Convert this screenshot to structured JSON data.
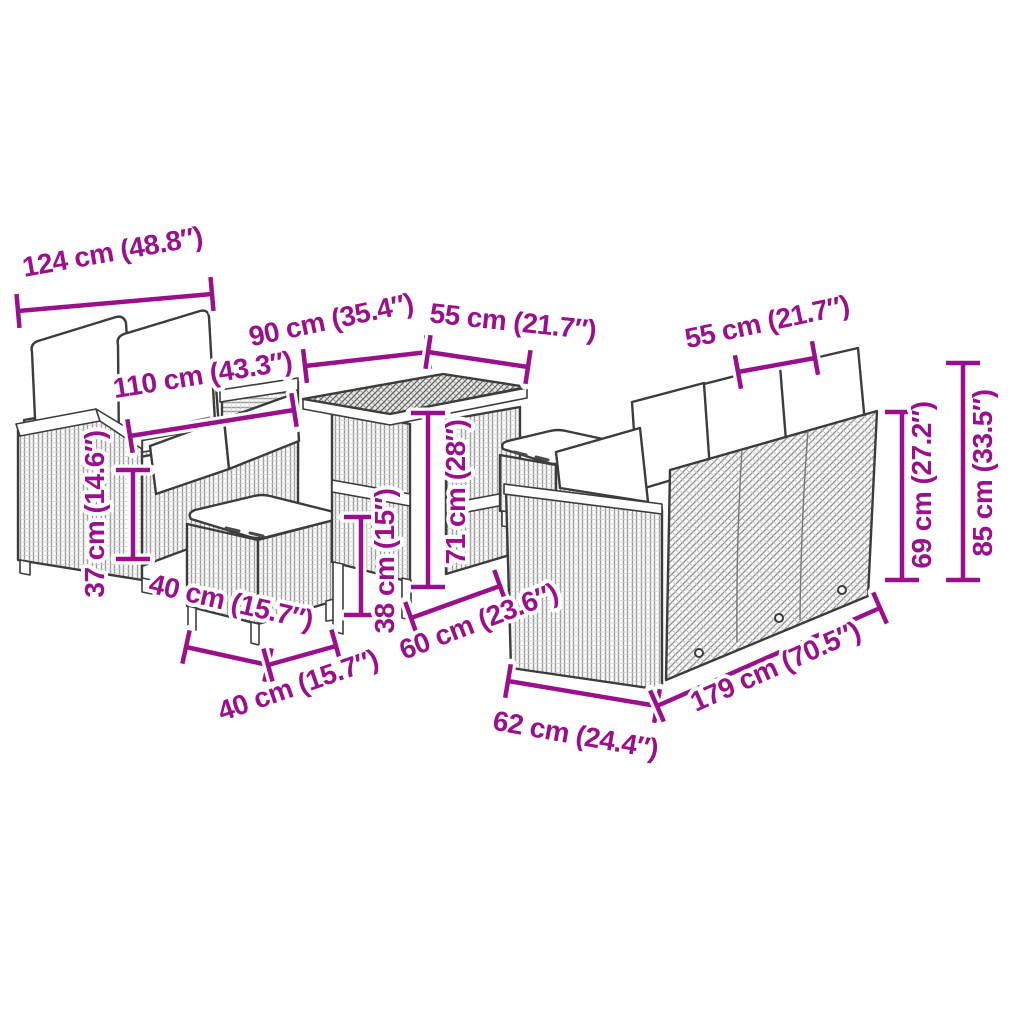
{
  "figure": {
    "title": "Garden furniture set dimension diagram",
    "background_color": "#ffffff",
    "accent_color": "#9a108c",
    "outline_color": "#3c3c3c",
    "units": [
      "cm",
      "inches"
    ]
  },
  "items": [
    {
      "id": "left-sofa",
      "label": "two-seater sofa with back and seat cushions"
    },
    {
      "id": "stool-1",
      "label": "stool with cushion"
    },
    {
      "id": "table",
      "label": "rattan table"
    },
    {
      "id": "stool-2",
      "label": "stool with cushion"
    },
    {
      "id": "right-sofa",
      "label": "three-seater sofa with back cushions"
    }
  ],
  "dimensions": [
    {
      "id": "left-sofa-back-width",
      "label": "124 cm (48.8″)"
    },
    {
      "id": "left-sofa-seat-width",
      "label": "110 cm (43.3″)"
    },
    {
      "id": "table-length",
      "label": "90 cm (35.4″)"
    },
    {
      "id": "table-width",
      "label": "55 cm (21.7″)"
    },
    {
      "id": "right-sofa-depth",
      "label": "55 cm (21.7″)"
    },
    {
      "id": "right-sofa-back-height",
      "label": "69 cm (27.2″)"
    },
    {
      "id": "right-sofa-total-height",
      "label": "85 cm (33.5″)"
    },
    {
      "id": "left-sofa-seat-height",
      "label": "37 cm (14.6″)"
    },
    {
      "id": "stool-depth",
      "label": "40 cm (15.7″)"
    },
    {
      "id": "stool-width",
      "label": "40 cm (15.7″)"
    },
    {
      "id": "stool-height",
      "label": "38 cm (15″)"
    },
    {
      "id": "table-height",
      "label": "71 cm (28″)"
    },
    {
      "id": "stool2-width",
      "label": "60 cm (23.6″)"
    },
    {
      "id": "right-sofa-seat-depth",
      "label": "62 cm (24.4″)"
    },
    {
      "id": "right-sofa-length",
      "label": "179 cm (70.5″)"
    }
  ]
}
